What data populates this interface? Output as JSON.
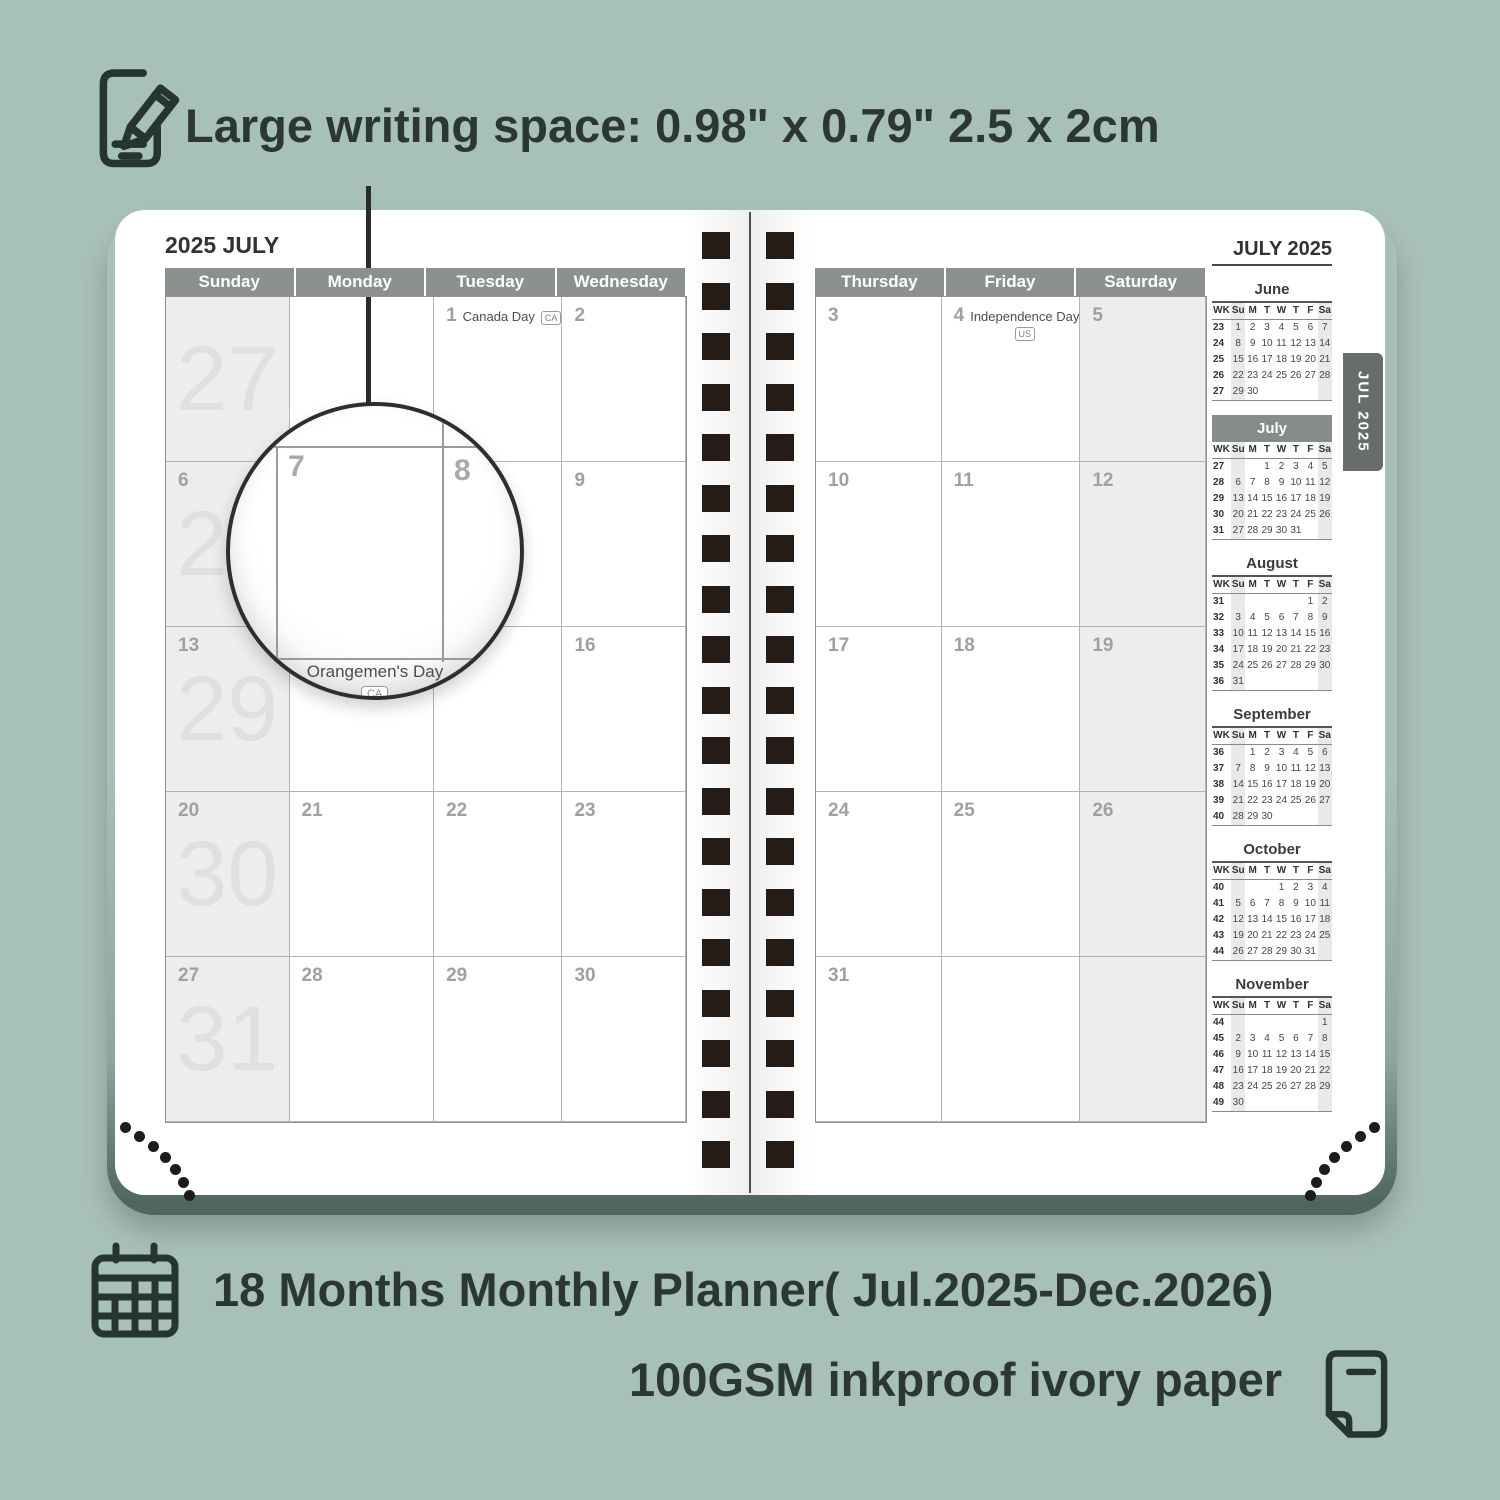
{
  "colors": {
    "background": "#a7c0b8",
    "page": "#ffffff",
    "header_bar": "#8c918d",
    "shaded_cell": "#ededed",
    "mini_highlight_bar": "#868c88",
    "tab": "#676d69",
    "binding_hole": "#251b17",
    "annotation_text": "#2c3734"
  },
  "top_note": {
    "text": "Large writing space: 0.98\" x 0.79\" 2.5 x 2cm"
  },
  "magnifier": {
    "day": "7",
    "next_day": "8",
    "holiday": "Orangemen's Day",
    "badge": "CA"
  },
  "left_page": {
    "title": "2025 JULY",
    "day_headers": [
      "Sunday",
      "Monday",
      "Tuesday",
      "Wednesday"
    ],
    "weeks": [
      {
        "week_number": "27",
        "cells": [
          {
            "day": ""
          },
          {
            "day": ""
          },
          {
            "day": "1",
            "holiday": "Canada Day",
            "badge": "CA",
            "badge_position": "inline"
          },
          {
            "day": "2"
          }
        ]
      },
      {
        "week_number": "28",
        "cells": [
          {
            "day": "6"
          },
          {
            "day": "7"
          },
          {
            "day": "8"
          },
          {
            "day": "9"
          }
        ]
      },
      {
        "week_number": "29",
        "cells": [
          {
            "day": "13"
          },
          {
            "day": "14",
            "holiday": "Orangemen's Day",
            "badge": "CA",
            "badge_position": "below"
          },
          {
            "day": "15"
          },
          {
            "day": "16"
          }
        ]
      },
      {
        "week_number": "30",
        "cells": [
          {
            "day": "20"
          },
          {
            "day": "21"
          },
          {
            "day": "22"
          },
          {
            "day": "23"
          }
        ]
      },
      {
        "week_number": "31",
        "cells": [
          {
            "day": "27"
          },
          {
            "day": "28"
          },
          {
            "day": "29"
          },
          {
            "day": "30"
          }
        ]
      }
    ]
  },
  "right_page": {
    "title": "JULY 2025",
    "tab": "JUL 2025",
    "day_headers": [
      "Thursday",
      "Friday",
      "Saturday"
    ],
    "weeks": [
      {
        "cells": [
          {
            "day": "3"
          },
          {
            "day": "4",
            "holiday": "Independence Day",
            "badge": "US",
            "badge_position": "below"
          },
          {
            "day": "5"
          }
        ]
      },
      {
        "cells": [
          {
            "day": "10"
          },
          {
            "day": "11"
          },
          {
            "day": "12"
          }
        ]
      },
      {
        "cells": [
          {
            "day": "17"
          },
          {
            "day": "18"
          },
          {
            "day": "19"
          }
        ]
      },
      {
        "cells": [
          {
            "day": "24"
          },
          {
            "day": "25"
          },
          {
            "day": "26"
          }
        ]
      },
      {
        "cells": [
          {
            "day": "31"
          },
          {
            "day": ""
          },
          {
            "day": ""
          }
        ]
      }
    ],
    "mini_months": [
      {
        "name": "June",
        "highlight": false,
        "cols": [
          "WK",
          "Su",
          "M",
          "T",
          "W",
          "T",
          "F",
          "Sa"
        ],
        "weeks": [
          {
            "wk": "23",
            "days": [
              "1",
              "2",
              "3",
              "4",
              "5",
              "6",
              "7"
            ]
          },
          {
            "wk": "24",
            "days": [
              "8",
              "9",
              "10",
              "11",
              "12",
              "13",
              "14"
            ]
          },
          {
            "wk": "25",
            "days": [
              "15",
              "16",
              "17",
              "18",
              "19",
              "20",
              "21"
            ]
          },
          {
            "wk": "26",
            "days": [
              "22",
              "23",
              "24",
              "25",
              "26",
              "27",
              "28"
            ]
          },
          {
            "wk": "27",
            "days": [
              "29",
              "30",
              "",
              "",
              "",
              "",
              ""
            ]
          }
        ]
      },
      {
        "name": "July",
        "highlight": true,
        "cols": [
          "WK",
          "Su",
          "M",
          "T",
          "W",
          "T",
          "F",
          "Sa"
        ],
        "weeks": [
          {
            "wk": "27",
            "days": [
              "",
              "",
              "1",
              "2",
              "3",
              "4",
              "5"
            ]
          },
          {
            "wk": "28",
            "days": [
              "6",
              "7",
              "8",
              "9",
              "10",
              "11",
              "12"
            ]
          },
          {
            "wk": "29",
            "days": [
              "13",
              "14",
              "15",
              "16",
              "17",
              "18",
              "19"
            ]
          },
          {
            "wk": "30",
            "days": [
              "20",
              "21",
              "22",
              "23",
              "24",
              "25",
              "26"
            ]
          },
          {
            "wk": "31",
            "days": [
              "27",
              "28",
              "29",
              "30",
              "31",
              "",
              ""
            ]
          }
        ]
      },
      {
        "name": "August",
        "highlight": false,
        "cols": [
          "WK",
          "Su",
          "M",
          "T",
          "W",
          "T",
          "F",
          "Sa"
        ],
        "weeks": [
          {
            "wk": "31",
            "days": [
              "",
              "",
              "",
              "",
              "",
              "1",
              "2"
            ]
          },
          {
            "wk": "32",
            "days": [
              "3",
              "4",
              "5",
              "6",
              "7",
              "8",
              "9"
            ]
          },
          {
            "wk": "33",
            "days": [
              "10",
              "11",
              "12",
              "13",
              "14",
              "15",
              "16"
            ]
          },
          {
            "wk": "34",
            "days": [
              "17",
              "18",
              "19",
              "20",
              "21",
              "22",
              "23"
            ]
          },
          {
            "wk": "35",
            "days": [
              "24",
              "25",
              "26",
              "27",
              "28",
              "29",
              "30"
            ]
          },
          {
            "wk": "36",
            "days": [
              "31",
              "",
              "",
              "",
              "",
              "",
              ""
            ]
          }
        ]
      },
      {
        "name": "September",
        "highlight": false,
        "cols": [
          "WK",
          "Su",
          "M",
          "T",
          "W",
          "T",
          "F",
          "Sa"
        ],
        "weeks": [
          {
            "wk": "36",
            "days": [
              "",
              "1",
              "2",
              "3",
              "4",
              "5",
              "6"
            ]
          },
          {
            "wk": "37",
            "days": [
              "7",
              "8",
              "9",
              "10",
              "11",
              "12",
              "13"
            ]
          },
          {
            "wk": "38",
            "days": [
              "14",
              "15",
              "16",
              "17",
              "18",
              "19",
              "20"
            ]
          },
          {
            "wk": "39",
            "days": [
              "21",
              "22",
              "23",
              "24",
              "25",
              "26",
              "27"
            ]
          },
          {
            "wk": "40",
            "days": [
              "28",
              "29",
              "30",
              "",
              "",
              "",
              ""
            ]
          }
        ]
      },
      {
        "name": "October",
        "highlight": false,
        "cols": [
          "WK",
          "Su",
          "M",
          "T",
          "W",
          "T",
          "F",
          "Sa"
        ],
        "weeks": [
          {
            "wk": "40",
            "days": [
              "",
              "",
              "",
              "1",
              "2",
              "3",
              "4"
            ]
          },
          {
            "wk": "41",
            "days": [
              "5",
              "6",
              "7",
              "8",
              "9",
              "10",
              "11"
            ]
          },
          {
            "wk": "42",
            "days": [
              "12",
              "13",
              "14",
              "15",
              "16",
              "17",
              "18"
            ]
          },
          {
            "wk": "43",
            "days": [
              "19",
              "20",
              "21",
              "22",
              "23",
              "24",
              "25"
            ]
          },
          {
            "wk": "44",
            "days": [
              "26",
              "27",
              "28",
              "29",
              "30",
              "31",
              ""
            ]
          }
        ]
      },
      {
        "name": "November",
        "highlight": false,
        "cols": [
          "WK",
          "Su",
          "M",
          "T",
          "W",
          "T",
          "F",
          "Sa"
        ],
        "weeks": [
          {
            "wk": "44",
            "days": [
              "",
              "",
              "",
              "",
              "",
              "",
              "1"
            ]
          },
          {
            "wk": "45",
            "days": [
              "2",
              "3",
              "4",
              "5",
              "6",
              "7",
              "8"
            ]
          },
          {
            "wk": "46",
            "days": [
              "9",
              "10",
              "11",
              "12",
              "13",
              "14",
              "15"
            ]
          },
          {
            "wk": "47",
            "days": [
              "16",
              "17",
              "18",
              "19",
              "20",
              "21",
              "22"
            ]
          },
          {
            "wk": "48",
            "days": [
              "23",
              "24",
              "25",
              "26",
              "27",
              "28",
              "29"
            ]
          },
          {
            "wk": "49",
            "days": [
              "30",
              "",
              "",
              "",
              "",
              "",
              ""
            ]
          }
        ]
      }
    ]
  },
  "bottom_notes": [
    {
      "text": "18 Months Monthly Planner( Jul.2025-Dec.2026)"
    },
    {
      "text": "100GSM inkproof ivory paper"
    }
  ]
}
